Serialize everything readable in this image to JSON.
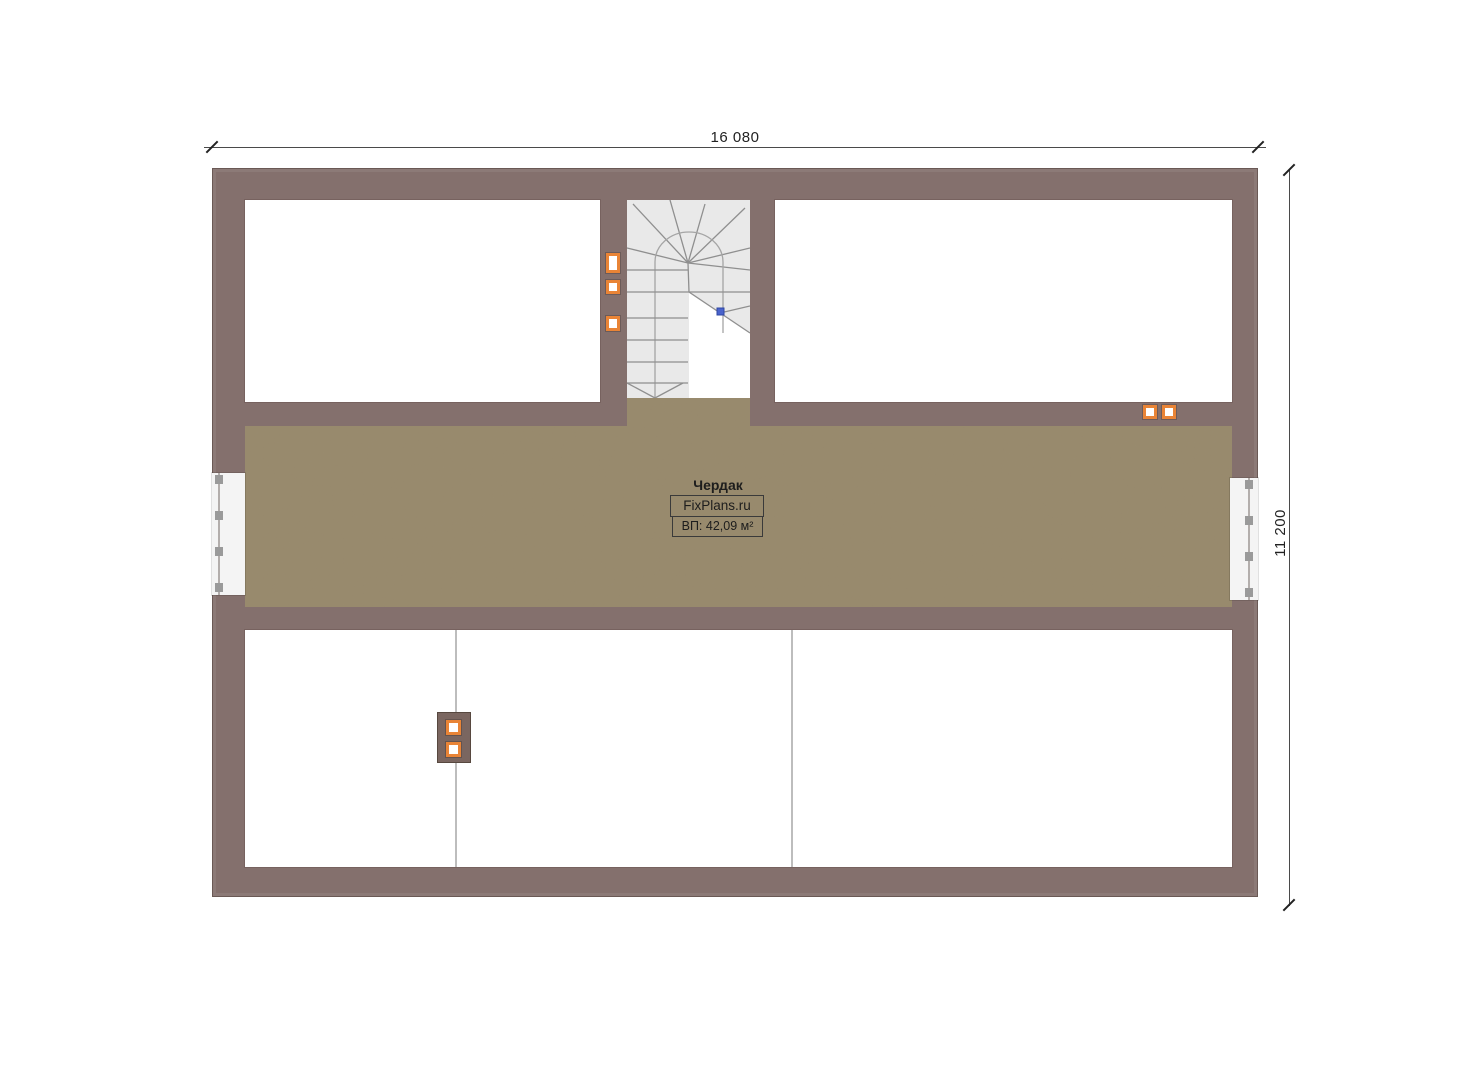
{
  "plan": {
    "room_label": "Чердак",
    "watermark": "FixPlans.ru",
    "area_label": "ВП: 42,09 м²",
    "dimensions": {
      "width_label": "16 080",
      "height_label": "11 200"
    }
  },
  "colors": {
    "wall": "#84706d",
    "wall_dark": "#6a5955",
    "floor_base": "#97876c",
    "stair_bg": "#e9e9e9",
    "stair_line": "#8f8f8f",
    "vent_orange": "#e98436",
    "chimney": "#7a6660",
    "partition": "#bdbdbd",
    "blue_marker": "#4a63cc"
  }
}
